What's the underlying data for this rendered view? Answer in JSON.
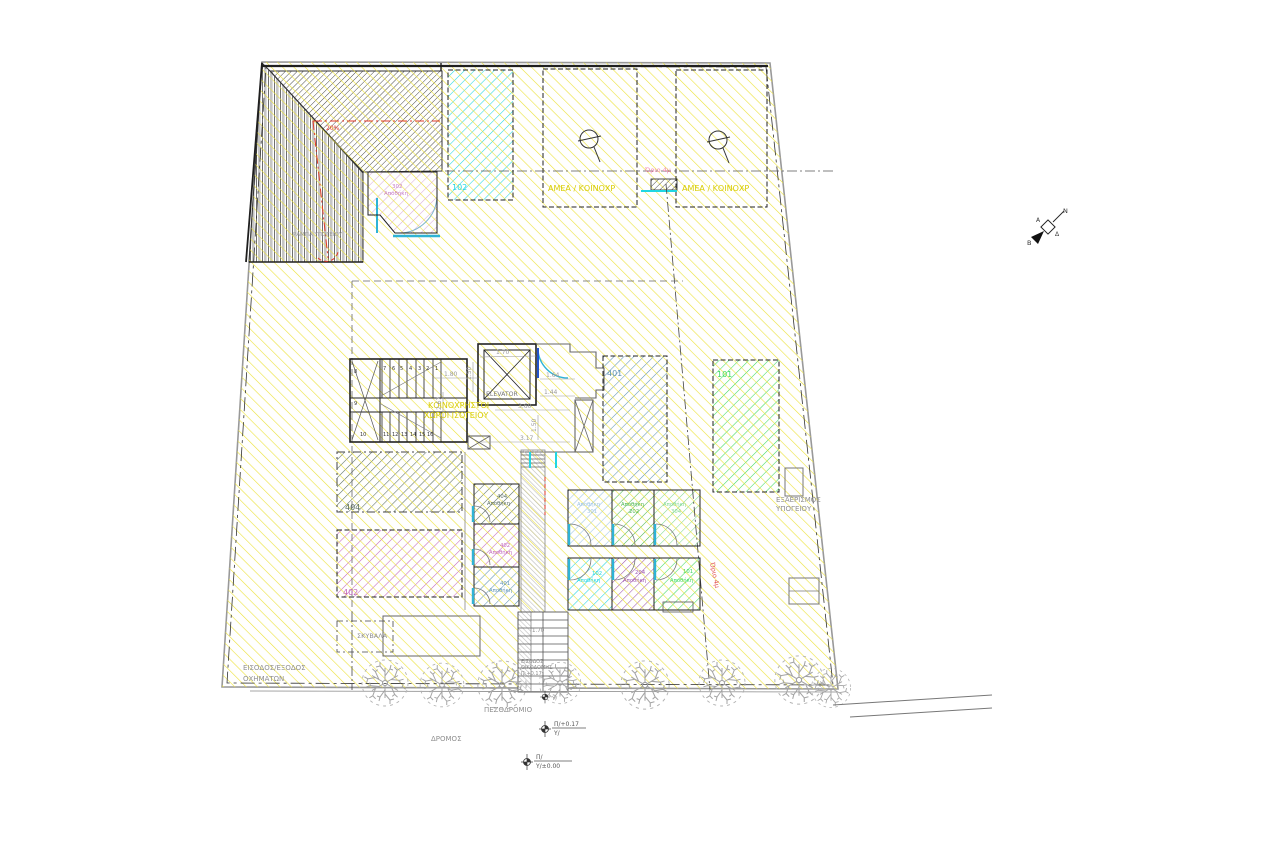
{
  "drawing": {
    "type": "architectural-site-plan",
    "colors": {
      "yellow_hatch": "#ece23a",
      "cyan_102": "#22d6e2",
      "blue_401": "#5f93b4",
      "green_101": "#3fdb5f",
      "dark_404": "#5a6e60",
      "magenta_402": "#c468bc",
      "pink_302": "#cf8fcf",
      "lightblue_301": "#9cc4e4",
      "green_202": "#4db74d",
      "lightgreen_304": "#84da92",
      "purple_204": "#9e56ae",
      "door_cyan": "#2fb3d5",
      "red_accent": "#e03a28",
      "pink_text": "#f285ad",
      "yellow_text": "#d8cc00",
      "gray_text": "#8f8f8f",
      "wall": "#1f1f1f"
    }
  },
  "rooms": {
    "r102": "102",
    "r401": "401",
    "r101": "101",
    "r404": "404",
    "r402": "402",
    "amea_left": "ΑΜΕΑ / ΚΟΙΝΟΧΡ",
    "amea_right": "ΑΜΕΑ / ΚΟΙΝΟΧΡ",
    "r302_num": "302",
    "r302_name": "Αποθήκη",
    "elevator": "ELEVATOR"
  },
  "storage": {
    "mid": [
      {
        "num": "404",
        "name": "Αποθήκη"
      },
      {
        "num": "402",
        "name": "Αποθήκη"
      },
      {
        "num": "401",
        "name": "Αποθήκη"
      }
    ],
    "top_row": [
      {
        "name": "Αποθήκη",
        "num": "301"
      },
      {
        "name": "Αποθήκη",
        "num": "202"
      },
      {
        "name": "Αποθήκη",
        "num": "304"
      }
    ],
    "bottom_row": [
      {
        "num": "102",
        "name": "Αποθήκη"
      },
      {
        "num": "204",
        "name": "Αποθήκη"
      },
      {
        "num": "101",
        "name": "Αποθήκη"
      }
    ]
  },
  "annotations": {
    "orio_top": "Όριο 4μ",
    "orio_side": "Όριο 4μ",
    "ramp_name": "ΡΑΜΠΑ ΥΠΟΓΕΙΟΥ",
    "ramp_slope": "20%",
    "common_line1": "ΚΟΙΝΟΧΡΗΣΤΟΙ",
    "common_line2": "ΧΩΡΟΙ ΙΣΟΓΕΙΟΥ",
    "vent_line1": "ΕΞΑΕΡΙΣΜΟΣ",
    "vent_line2": "ΥΠΟΓΕΙΟΥ",
    "vehicles_line1": "ΕΙΣΟΔΟΣ/ΕΞΟΔΟΣ",
    "vehicles_line2": "ΟΧΗΜΑΤΩΝ",
    "garbage": "ΣΚΥΒΑΛΑ",
    "sidewalk": "ΠΕΖΟΔΡΟΜΙΟ",
    "road": "ΔΡΟΜΟΣ",
    "entrance_line1": "ΕΙΣΟΔΟΣ",
    "entrance_line2": "ΟΙΚΟΔΟΜΗΣ",
    "entrance_line3": "Π:+0.17"
  },
  "levels": {
    "m1_top": "Π/+0.17",
    "m1_bottom": "Υ/",
    "m2_top": "Π/",
    "m2_bottom": "Υ/±0.00",
    "m3": "Υ/"
  },
  "dimensions": {
    "elevator_width": "1.70",
    "stair_width": "1.80",
    "landing_a": "1.50",
    "lobby_a": "1.64",
    "lobby_b": "1.44",
    "corridor_a": "3.60",
    "landing_b": "1.50",
    "corridor_b": "3.17",
    "stair_len": "2.67",
    "walkway": "1.70"
  },
  "stairs": {
    "labels": [
      "7",
      "6",
      "5",
      "4",
      "3",
      "2",
      "1",
      "8",
      "9",
      "10",
      "11",
      "12",
      "13",
      "14",
      "15",
      "16"
    ]
  },
  "compass": {
    "ne": "Ν",
    "nw": "Α",
    "se": "Δ",
    "sw": "Β"
  }
}
